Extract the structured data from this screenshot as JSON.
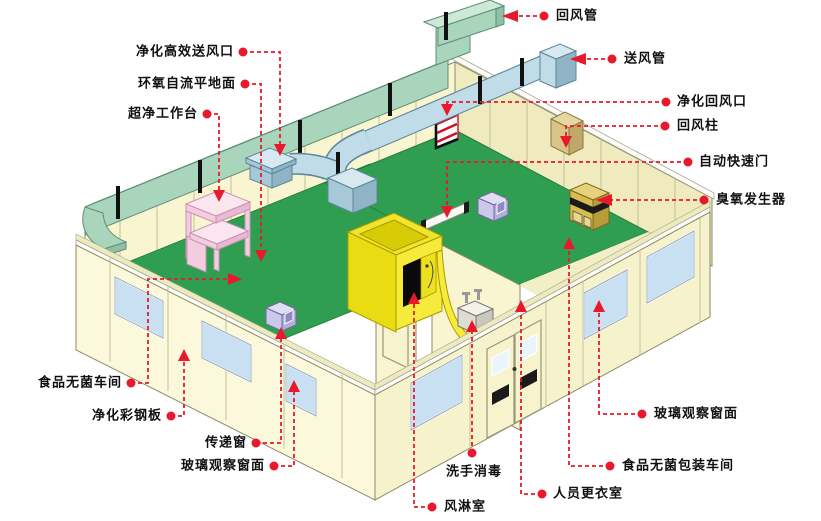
{
  "colors": {
    "leader_red": "#E8192C",
    "floor_green": "#2F9E50",
    "wall_cream": "#F8F5D0",
    "wall_cream_dark": "#EFEBBE",
    "duct_mint": "#A8D5BB",
    "duct_mint_top": "#CDEAD8",
    "duct_blue": "#BFDCE8",
    "duct_blue_dark": "#8FB4C6",
    "air_shower_yellow": "#F6EB3B",
    "workbench_pink": "#F4CCE0",
    "pass_box_lavender": "#CCC8EA",
    "ozone_yellow": "#D8BC50",
    "window_blue": "#C9E0F2",
    "label_text": "#111111"
  },
  "labels": [
    {
      "id": "return-air-duct",
      "text": "回风管"
    },
    {
      "id": "supply-air-duct",
      "text": "送风管"
    },
    {
      "id": "purifying-return-air-outlet",
      "text": "净化回风口"
    },
    {
      "id": "return-air-column",
      "text": "回风柱"
    },
    {
      "id": "automatic-rapid-door",
      "text": "自动快速门"
    },
    {
      "id": "ozone-generator",
      "text": "臭氧发生器"
    },
    {
      "id": "purifying-hepa-supply-outlet",
      "text": "净化高效送风口"
    },
    {
      "id": "epoxy-self-leveling-floor",
      "text": "环氧自流平地面"
    },
    {
      "id": "ultra-clean-workbench",
      "text": "超净工作台"
    },
    {
      "id": "food-sterile-workshop",
      "text": "食品无菌车间"
    },
    {
      "id": "purifying-color-steel-panel",
      "text": "净化彩钢板"
    },
    {
      "id": "transfer-window",
      "text": "传递窗"
    },
    {
      "id": "glass-observation-window-left",
      "text": "玻璃观察窗面"
    },
    {
      "id": "air-shower-room",
      "text": "风淋室"
    },
    {
      "id": "hand-wash-disinfection",
      "text": "洗手消毒"
    },
    {
      "id": "staff-changing-room",
      "text": "人员更衣室"
    },
    {
      "id": "food-sterile-packaging-workshop",
      "text": "食品无菌包装车间"
    },
    {
      "id": "glass-observation-window-right",
      "text": "玻璃观察窗面"
    }
  ]
}
